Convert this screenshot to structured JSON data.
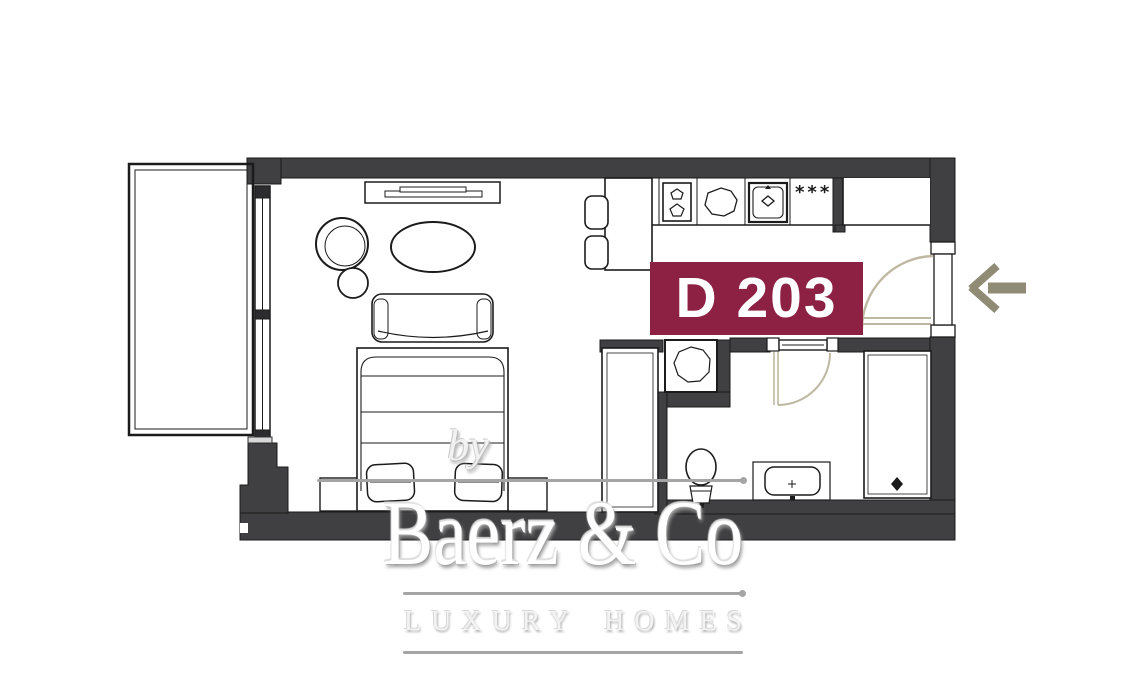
{
  "unit_label": {
    "text": "D 203",
    "background": "#8d2144",
    "color": "#ffffff"
  },
  "kitchen": {
    "freezer_stars": "***"
  },
  "watermark": {
    "by": "by",
    "brand": "Baerz & Co",
    "tagline": "LUXURY HOMES"
  },
  "colors": {
    "walls": "#403f41",
    "line_work": "#1b1b1b",
    "door_swing": "#beb8a2",
    "entry_arrow": "#8f8b75",
    "accent": "#8d2144",
    "watermark_gray": "#a5a5a5"
  }
}
